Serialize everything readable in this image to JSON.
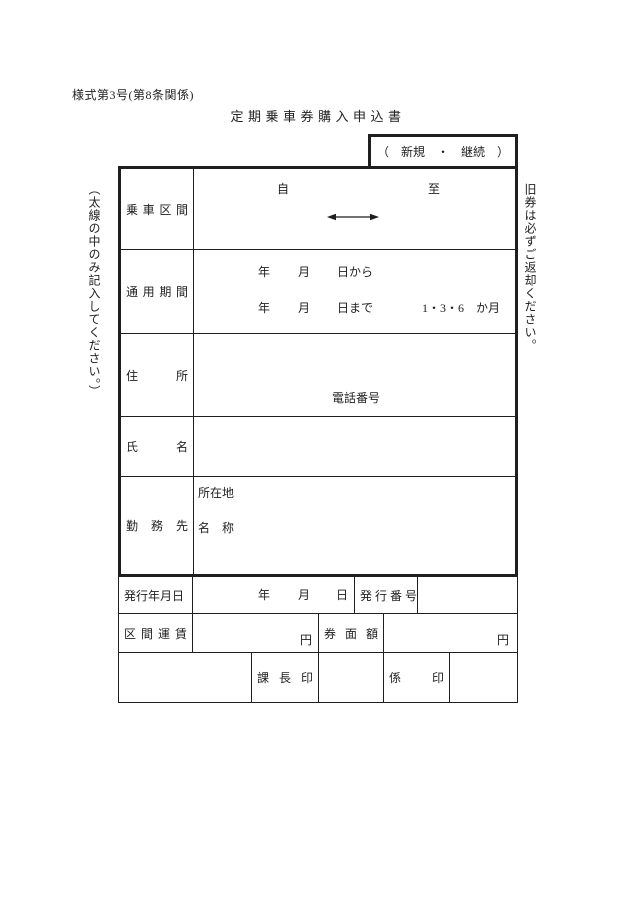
{
  "page": {
    "form_number": "様式第3号(第8条関係)",
    "title": "定期乗車券購入申込書"
  },
  "notes": {
    "left_vertical": "（太線の中のみ記入してください。）",
    "right_vertical": "旧券は必ずご返却ください。"
  },
  "colors": {
    "ink": "#1f1f1f",
    "paper": "#ffffff"
  },
  "form": {
    "type_choice": "（　新規　・　継続　）",
    "ride_section": {
      "label": "乗 車 区 間",
      "from_label": "自",
      "to_label": "至"
    },
    "valid_period": {
      "label": "通 用 期 間",
      "line1": {
        "year": "年",
        "month": "月",
        "day": "日から"
      },
      "line2": {
        "year": "年",
        "month": "月",
        "day": "日まで",
        "duration": "1・3・6　か月"
      }
    },
    "address": {
      "label": "住　　所",
      "phone_label": "電話番号"
    },
    "name": {
      "label": "氏　　名"
    },
    "workplace": {
      "label": "勤 務 先",
      "location_label": "所在地",
      "name_label": "名　称"
    }
  },
  "office": {
    "issue_date": {
      "label": "発行年月日",
      "year": "年",
      "month": "月",
      "day": "日"
    },
    "issue_number_label": "発 行 番 号",
    "section_fare": {
      "label": "区 間 運 賃",
      "unit": "円"
    },
    "face_value": {
      "label": "券 面 額",
      "unit": "円"
    },
    "manager_seal_label": "課 長 印",
    "staff_seal_label": "係　　印"
  }
}
